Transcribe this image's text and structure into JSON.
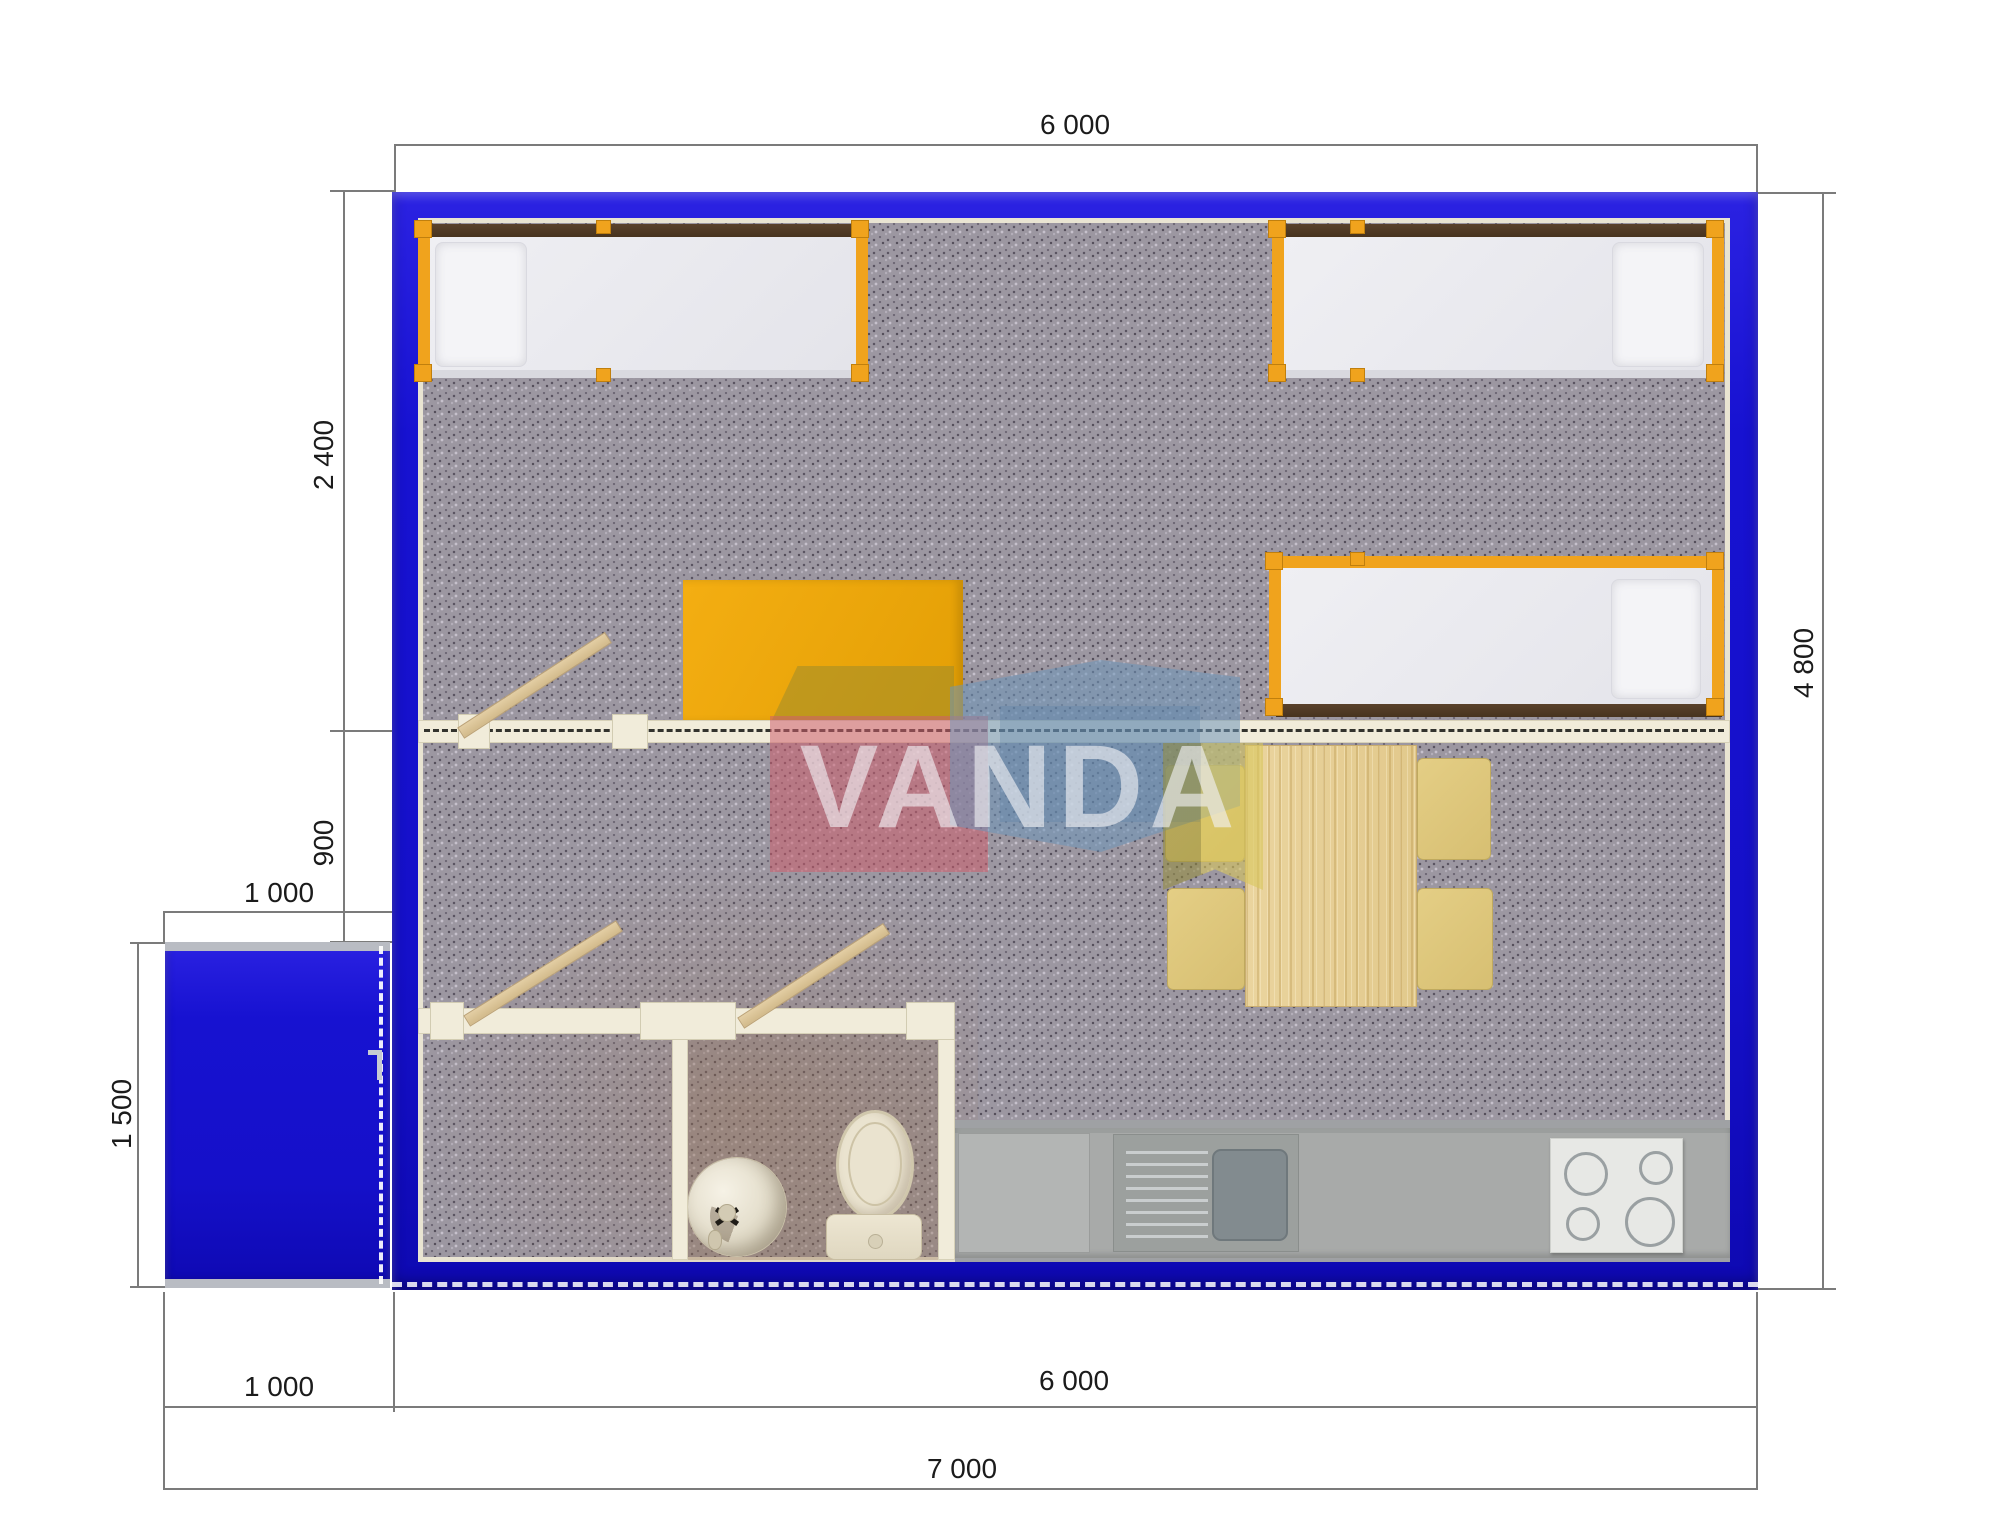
{
  "title": "Modular cabin floor plan 7000x4800",
  "watermark": {
    "brand": "VANDA"
  },
  "dimensions": {
    "top_width": "6 000",
    "bedroom_depth": "2 400",
    "hall_depth": "900",
    "porch_width_top": "1 000",
    "porch_depth": "1 500",
    "total_depth_right": "4 800",
    "porch_width_bottom": "1 000",
    "main_width_bottom": "6 000",
    "total_width_bottom": "7 000"
  },
  "colors": {
    "wall_blue": "#1712D1",
    "inner_liner_cream": "#E9E4D2",
    "partition_cream": "#F1ECDA",
    "carpet_gray": "#9C97A1",
    "accent_orange": "#F0A31D",
    "desk_orange": "#EDA50C",
    "bed_rail_brown": "#4F3A26",
    "table_wood": "#E8D29A",
    "chair_tan": "#DFC87E",
    "counter_gray": "#A6A8A7",
    "stove_white": "#E7E8E5",
    "sink_basin_gray": "#869094",
    "fixture_cream": "#EAE3CF",
    "logo_red": "#D97F8E",
    "logo_blue": "#7FA3C4",
    "logo_yellow": "#D9CB7B",
    "dimension_line_gray": "#7B7B7B",
    "dimension_text": "#1B1B1B"
  }
}
